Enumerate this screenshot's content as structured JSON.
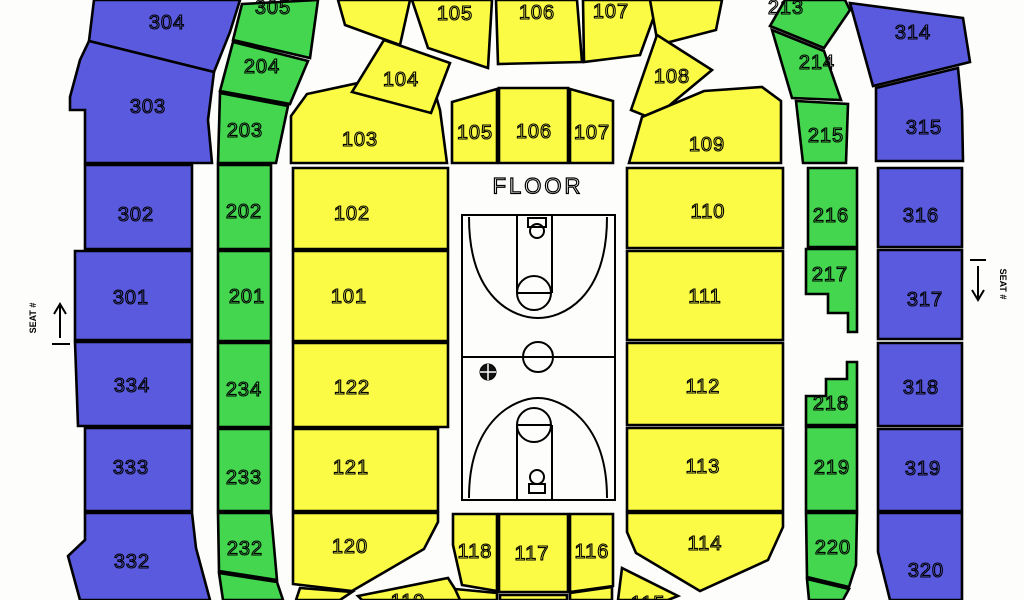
{
  "floor_label": "FLOOR",
  "markers": {
    "left_label": "SEAT #",
    "right_label": "SEAT #"
  },
  "colors": {
    "level_100": "#FBFB45",
    "level_200": "#43D64E",
    "level_300": "#5A5ADF",
    "outline": "#000000",
    "background": "#FDFDFB"
  },
  "sections": [
    {
      "label": "304",
      "level": 300,
      "pts": [
        94,
        0,
        240,
        0,
        230,
        32,
        214,
        72,
        89,
        41
      ],
      "lx": 167,
      "ly": 23
    },
    {
      "label": "303",
      "level": 300,
      "pts": [
        89,
        41,
        214,
        72,
        208,
        120,
        212,
        163,
        85,
        163,
        85,
        110,
        70,
        110,
        70,
        97,
        80,
        60
      ],
      "lx": 148,
      "ly": 107
    },
    {
      "label": "302",
      "level": 300,
      "pts": [
        85,
        165,
        192,
        165,
        192,
        249,
        85,
        249
      ],
      "lx": 136,
      "ly": 215
    },
    {
      "label": "301",
      "level": 300,
      "pts": [
        75,
        251,
        192,
        251,
        192,
        340,
        75,
        340
      ],
      "lx": 131,
      "ly": 298
    },
    {
      "label": "334",
      "level": 300,
      "pts": [
        75,
        342,
        192,
        342,
        192,
        426,
        78,
        426
      ],
      "lx": 132,
      "ly": 386
    },
    {
      "label": "333",
      "level": 300,
      "pts": [
        85,
        428,
        192,
        428,
        192,
        511,
        85,
        511
      ],
      "lx": 131,
      "ly": 468
    },
    {
      "label": "332",
      "level": 300,
      "pts": [
        85,
        513,
        192,
        513,
        196,
        548,
        210,
        600,
        80,
        600,
        68,
        556,
        85,
        540
      ],
      "lx": 132,
      "ly": 562
    },
    {
      "label": "305",
      "level": 200,
      "pts": [
        242,
        4,
        318,
        0,
        310,
        58,
        233,
        40
      ],
      "lx": 273,
      "ly": 8
    },
    {
      "label": "204",
      "level": 200,
      "pts": [
        233,
        42,
        308,
        61,
        290,
        104,
        220,
        91
      ],
      "lx": 262,
      "ly": 67
    },
    {
      "label": "203",
      "level": 200,
      "pts": [
        220,
        93,
        288,
        106,
        276,
        163,
        218,
        163
      ],
      "lx": 245,
      "ly": 131
    },
    {
      "label": "202",
      "level": 200,
      "pts": [
        218,
        165,
        271,
        165,
        271,
        249,
        218,
        249
      ],
      "lx": 244,
      "ly": 212
    },
    {
      "label": "201",
      "level": 200,
      "pts": [
        218,
        251,
        271,
        251,
        271,
        341,
        218,
        341
      ],
      "lx": 247,
      "ly": 297
    },
    {
      "label": "234",
      "level": 200,
      "pts": [
        218,
        343,
        271,
        343,
        271,
        427,
        218,
        427
      ],
      "lx": 244,
      "ly": 390
    },
    {
      "label": "233",
      "level": 200,
      "pts": [
        218,
        429,
        271,
        429,
        271,
        511,
        218,
        511
      ],
      "lx": 244,
      "ly": 478
    },
    {
      "label": "232",
      "level": 200,
      "pts": [
        218,
        513,
        271,
        513,
        277,
        580,
        219,
        571
      ],
      "lx": 245,
      "ly": 549
    },
    {
      "label": "",
      "level": 200,
      "pts": [
        219,
        573,
        277,
        582,
        283,
        600,
        223,
        600
      ]
    },
    {
      "label": "103",
      "level": 100,
      "pts": [
        291,
        163,
        291,
        116,
        307,
        94,
        428,
        68,
        440,
        110,
        447,
        163
      ],
      "lx": 360,
      "ly": 140
    },
    {
      "label": "104",
      "level": 100,
      "pts": [
        352,
        92,
        384,
        40,
        450,
        63,
        431,
        113
      ],
      "lx": 401,
      "ly": 80
    },
    {
      "label": "",
      "level": 100,
      "pts": [
        338,
        0,
        410,
        0,
        400,
        45,
        345,
        25
      ]
    },
    {
      "label": "105",
      "level": 100,
      "pts": [
        412,
        0,
        492,
        0,
        488,
        68,
        428,
        48
      ],
      "lx": 455,
      "ly": 14
    },
    {
      "label": "106",
      "level": 100,
      "pts": [
        496,
        0,
        577,
        0,
        582,
        62,
        498,
        64
      ],
      "lx": 537,
      "ly": 13
    },
    {
      "label": "107",
      "level": 100,
      "pts": [
        583,
        0,
        660,
        0,
        640,
        55,
        584,
        62
      ],
      "lx": 611,
      "ly": 12
    },
    {
      "label": "",
      "level": 100,
      "pts": [
        650,
        0,
        722,
        0,
        716,
        30,
        658,
        45
      ]
    },
    {
      "label": "108",
      "level": 100,
      "pts": [
        631,
        110,
        657,
        35,
        712,
        70,
        653,
        119
      ],
      "lx": 672,
      "ly": 77
    },
    {
      "label": "109",
      "level": 100,
      "pts": [
        629,
        163,
        642,
        117,
        704,
        91,
        762,
        87,
        781,
        101,
        781,
        163
      ],
      "lx": 707,
      "ly": 145
    },
    {
      "label": "102",
      "level": 100,
      "pts": [
        293,
        168,
        448,
        168,
        448,
        249,
        293,
        249
      ],
      "lx": 352,
      "ly": 214
    },
    {
      "label": "101",
      "level": 100,
      "pts": [
        293,
        251,
        448,
        251,
        448,
        341,
        293,
        341
      ],
      "lx": 349,
      "ly": 297
    },
    {
      "label": "122",
      "level": 100,
      "pts": [
        293,
        343,
        448,
        343,
        448,
        427,
        293,
        427
      ],
      "lx": 352,
      "ly": 388
    },
    {
      "label": "121",
      "level": 100,
      "pts": [
        293,
        429,
        438,
        429,
        438,
        511,
        293,
        511
      ],
      "lx": 351,
      "ly": 468
    },
    {
      "label": "120",
      "level": 100,
      "pts": [
        293,
        513,
        438,
        513,
        438,
        522,
        424,
        549,
        352,
        591,
        293,
        584
      ],
      "lx": 350,
      "ly": 547
    },
    {
      "label": "",
      "level": 100,
      "pts": [
        300,
        588,
        352,
        592,
        340,
        600,
        296,
        600
      ]
    },
    {
      "label": "119",
      "level": 100,
      "pts": [
        358,
        596,
        448,
        578,
        462,
        600,
        362,
        600
      ],
      "lx": 408,
      "ly": 602
    },
    {
      "label": "105",
      "level": 100,
      "pts": [
        452,
        102,
        497,
        89,
        497,
        163,
        452,
        163
      ],
      "lx": 475,
      "ly": 133
    },
    {
      "label": "106",
      "level": 100,
      "pts": [
        499,
        88,
        568,
        88,
        568,
        163,
        499,
        163
      ],
      "lx": 534,
      "ly": 132
    },
    {
      "label": "107",
      "level": 100,
      "pts": [
        570,
        89,
        613,
        101,
        613,
        163,
        570,
        163
      ],
      "lx": 592,
      "ly": 133
    },
    {
      "label": "110",
      "level": 100,
      "pts": [
        627,
        168,
        783,
        168,
        783,
        248,
        627,
        248
      ],
      "lx": 708,
      "ly": 212
    },
    {
      "label": "111",
      "level": 100,
      "pts": [
        627,
        251,
        783,
        251,
        783,
        340,
        627,
        340
      ],
      "lx": 705,
      "ly": 297
    },
    {
      "label": "112",
      "level": 100,
      "pts": [
        627,
        343,
        783,
        343,
        783,
        425,
        627,
        425
      ],
      "lx": 703,
      "ly": 387
    },
    {
      "label": "113",
      "level": 100,
      "pts": [
        627,
        428,
        783,
        428,
        783,
        511,
        627,
        511
      ],
      "lx": 703,
      "ly": 467
    },
    {
      "label": "114",
      "level": 100,
      "pts": [
        627,
        513,
        783,
        513,
        783,
        527,
        768,
        560,
        700,
        591,
        636,
        553,
        627,
        532
      ],
      "lx": 705,
      "ly": 544
    },
    {
      "label": "115",
      "level": 100,
      "pts": [
        622,
        568,
        678,
        596,
        668,
        600,
        618,
        600
      ],
      "lx": 648,
      "ly": 604
    },
    {
      "label": "118",
      "level": 100,
      "pts": [
        453,
        514,
        497,
        514,
        497,
        591,
        462,
        585,
        453,
        545
      ],
      "lx": 475,
      "ly": 552
    },
    {
      "label": "117",
      "level": 100,
      "pts": [
        499,
        514,
        568,
        514,
        568,
        592,
        499,
        592
      ],
      "lx": 532,
      "ly": 554
    },
    {
      "label": "116",
      "level": 100,
      "pts": [
        570,
        514,
        613,
        514,
        613,
        586,
        570,
        592
      ],
      "lx": 592,
      "ly": 552
    },
    {
      "label": "",
      "level": 100,
      "pts": [
        455,
        589,
        497,
        593,
        497,
        600,
        460,
        600
      ]
    },
    {
      "label": "",
      "level": 100,
      "pts": [
        500,
        595,
        567,
        595,
        567,
        600,
        500,
        600
      ]
    },
    {
      "label": "",
      "level": 100,
      "pts": [
        570,
        593,
        612,
        587,
        612,
        600,
        570,
        600
      ]
    },
    {
      "label": "213",
      "level": 200,
      "pts": [
        770,
        26,
        824,
        48,
        850,
        10,
        845,
        0,
        785,
        0
      ],
      "lx": 786,
      "ly": 8
    },
    {
      "label": "214",
      "level": 200,
      "pts": [
        772,
        30,
        824,
        51,
        841,
        100,
        792,
        98
      ],
      "lx": 817,
      "ly": 63
    },
    {
      "label": "215",
      "level": 200,
      "pts": [
        796,
        101,
        848,
        104,
        846,
        163,
        803,
        163
      ],
      "lx": 826,
      "ly": 136
    },
    {
      "label": "216",
      "level": 200,
      "pts": [
        808,
        168,
        857,
        168,
        857,
        247,
        808,
        247
      ],
      "lx": 831,
      "ly": 216
    },
    {
      "label": "217",
      "level": 200,
      "pts": [
        806,
        249,
        857,
        249,
        857,
        332,
        848,
        332,
        848,
        313,
        828,
        313,
        828,
        294,
        806,
        294
      ],
      "lx": 830,
      "ly": 275
    },
    {
      "label": "218",
      "level": 200,
      "pts": [
        806,
        396,
        826,
        396,
        826,
        379,
        847,
        379,
        847,
        362,
        857,
        362,
        857,
        425,
        806,
        425
      ],
      "lx": 831,
      "ly": 404
    },
    {
      "label": "219",
      "level": 200,
      "pts": [
        806,
        427,
        857,
        427,
        857,
        511,
        806,
        511
      ],
      "lx": 832,
      "ly": 468
    },
    {
      "label": "220",
      "level": 200,
      "pts": [
        806,
        513,
        857,
        513,
        856,
        565,
        849,
        587,
        807,
        577
      ],
      "lx": 833,
      "ly": 548
    },
    {
      "label": "",
      "level": 200,
      "pts": [
        807,
        579,
        849,
        589,
        843,
        600,
        809,
        600
      ]
    },
    {
      "label": "314",
      "level": 300,
      "pts": [
        850,
        3,
        963,
        18,
        970,
        62,
        873,
        86
      ],
      "lx": 913,
      "ly": 33
    },
    {
      "label": "315",
      "level": 300,
      "pts": [
        876,
        88,
        958,
        68,
        962,
        110,
        963,
        161,
        876,
        161
      ],
      "lx": 924,
      "ly": 128
    },
    {
      "label": "316",
      "level": 300,
      "pts": [
        878,
        168,
        962,
        168,
        962,
        247,
        878,
        247
      ],
      "lx": 921,
      "ly": 216
    },
    {
      "label": "317",
      "level": 300,
      "pts": [
        878,
        250,
        962,
        250,
        962,
        339,
        878,
        339
      ],
      "lx": 925,
      "ly": 300
    },
    {
      "label": "318",
      "level": 300,
      "pts": [
        878,
        343,
        962,
        343,
        962,
        426,
        878,
        426
      ],
      "lx": 921,
      "ly": 388
    },
    {
      "label": "319",
      "level": 300,
      "pts": [
        878,
        429,
        962,
        429,
        962,
        511,
        878,
        511
      ],
      "lx": 923,
      "ly": 469
    },
    {
      "label": "320",
      "level": 300,
      "pts": [
        878,
        513,
        962,
        513,
        962,
        600,
        890,
        600,
        878,
        552
      ],
      "lx": 926,
      "ly": 571
    }
  ]
}
